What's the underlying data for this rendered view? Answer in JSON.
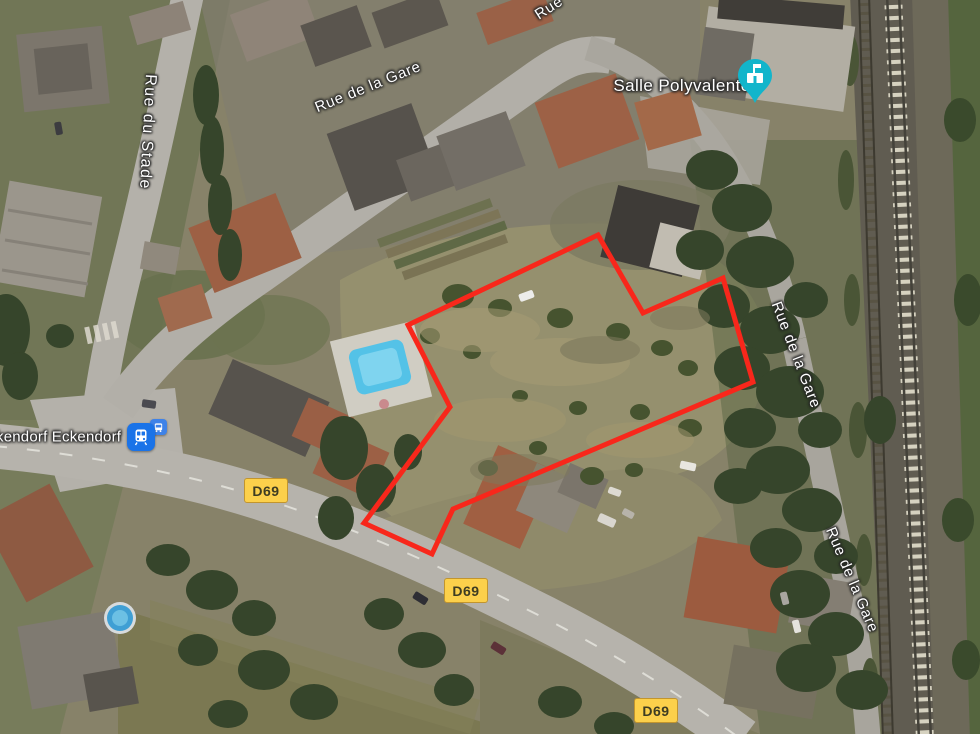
{
  "map": {
    "streets": {
      "rue_du_stade": "Rue du Stade",
      "rue_de_la_gare_top": "Rue de la Gare",
      "rue_partial_top": "Rue",
      "rue_de_la_gare_right_upper": "Rue de la Gare",
      "rue_de_la_gare_right_lower": "Rue de la Gare"
    },
    "poi": {
      "name": "Salle Polyvalente",
      "pin_color": "#12B5CB",
      "pin_icon": "civic-building"
    },
    "transit": {
      "stop_name": "kendorf Eckendorf",
      "icon_color": "#1A73E8",
      "icons": [
        "train",
        "bus"
      ]
    },
    "badges": {
      "d69": "D69",
      "background": "#FCD04B",
      "count": 3
    },
    "boundary": {
      "points": "598,235 643,313 723,278 753,382 453,509 432,554 364,523 450,407 408,325",
      "color": "#F8271B"
    }
  }
}
